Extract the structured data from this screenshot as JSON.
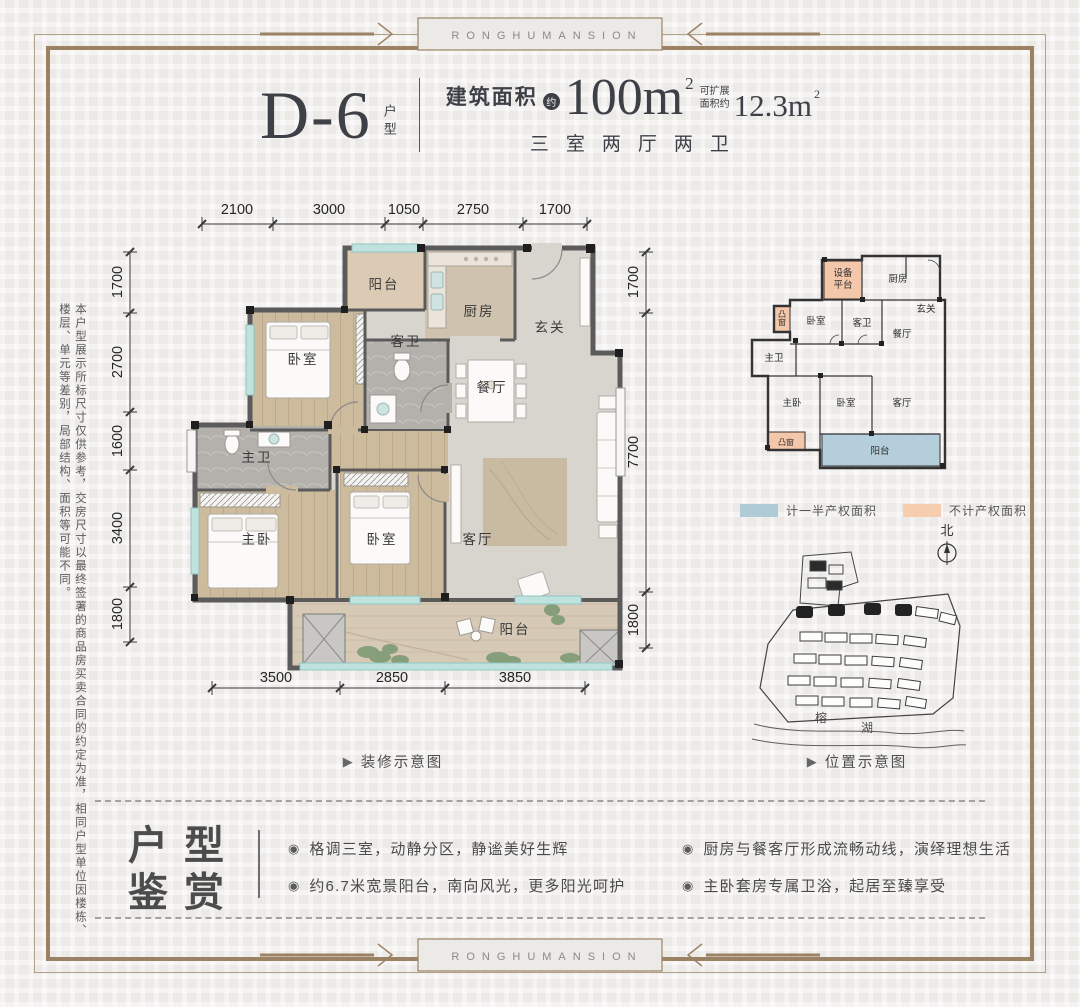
{
  "brand": {
    "banner_text": "RONGHUMANSION"
  },
  "header": {
    "unit_code": "D-6",
    "unit_type_label": "户型",
    "area_prefix": "建筑面积",
    "area_approx_badge": "约",
    "area_value": "100m",
    "area_superscript": "2",
    "expand_label_line1": "可扩展",
    "expand_label_line2": "面积约",
    "expand_value": "12.3m",
    "expand_superscript": "2",
    "rooms_summary": "三室两厅两卫"
  },
  "side_note": "本户型展示所标尺寸仅供参考，交房尺寸以最终签署的商品房买卖合同的约定为准，相同户型单位因楼栋、楼层、单元等差别，局部结构、面积等可能不同。",
  "icons": {
    "caption_play": "▶",
    "bullet": "◉"
  },
  "main_plan": {
    "caption": "装修示意图",
    "dims_top": [
      "2100",
      "3000",
      "1050",
      "2750",
      "1700"
    ],
    "dims_left": [
      "1700",
      "2700",
      "1600",
      "3400",
      "1800"
    ],
    "dims_right": [
      "1700",
      "7700",
      "1800"
    ],
    "dims_bottom": [
      "3500",
      "2850",
      "3850"
    ],
    "rooms": {
      "balcony_top": "阳台",
      "kitchen": "厨房",
      "foyer": "玄关",
      "guest_bath": "客卫",
      "bedroom_top": "卧室",
      "dining": "餐厅",
      "master_bath": "主卫",
      "master_bedroom": "主卧",
      "bedroom_mid": "卧室",
      "living": "客厅",
      "balcony_bottom": "阳台"
    }
  },
  "mini_plan": {
    "caption": "位置示意图",
    "rooms": {
      "equipment_platform_line1": "设备",
      "equipment_platform_line2": "平台",
      "kitchen": "厨房",
      "foyer": "玄关",
      "bedroom_top": "卧室",
      "guest_bath": "客卫",
      "dining": "餐厅",
      "master_bath": "主卫",
      "master_bedroom": "主卧",
      "bedroom_mid": "卧室",
      "living": "客厅",
      "balcony": "阳台",
      "bay_window_left": "凸窗",
      "bay_window_bottom": "凸窗"
    },
    "legend": [
      {
        "label": "计一半产权面积",
        "color": "#aecbd6"
      },
      {
        "label": "不计产权面积",
        "color": "#f6cdae"
      }
    ],
    "north_label": "北"
  },
  "site_plan": {
    "lake_char_1": "榕",
    "lake_char_2": "湖"
  },
  "features": {
    "title_line1": "户型",
    "title_line2": "鉴赏",
    "left_bullets": [
      "格调三室，动静分区，静谧美好生辉",
      "约6.7米宽景阳台，南向风光，更多阳光呵护"
    ],
    "right_bullets": [
      "厨房与餐客厅形成流畅动线，演绎理想生活",
      "主卧套房专属卫浴，起居至臻享受"
    ]
  },
  "colors": {
    "frame_brown": "#9b8264",
    "title_dark": "#3d4147",
    "balcony_blue": "#b5cedb",
    "highlight_pink": "#f4c7ab",
    "legend_blue": "#aecbd6",
    "legend_orange": "#f6cdae"
  }
}
